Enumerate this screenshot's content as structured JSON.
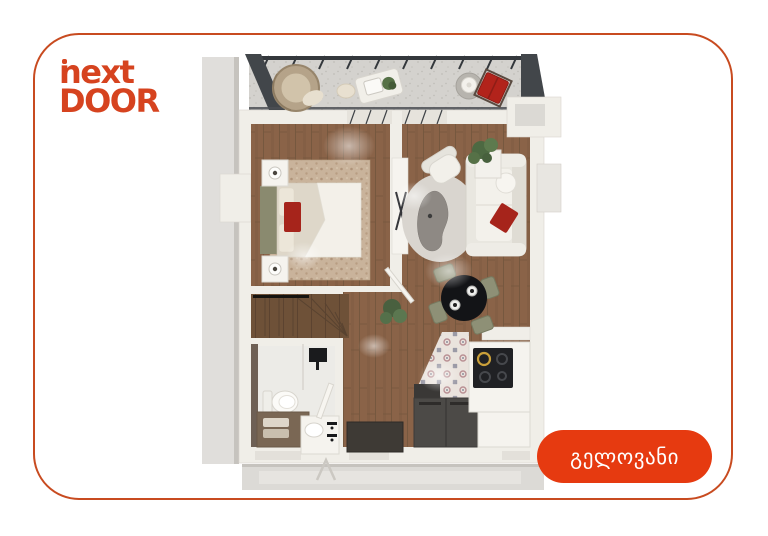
{
  "logo": {
    "line1": "next",
    "line2": "DOOR"
  },
  "badge": {
    "label": "გელოვანი"
  },
  "colors": {
    "background": "#ffffff",
    "card_border": "#c84b20",
    "accent": "#d6431f",
    "badge_bg": "#e63a10",
    "badge_text": "#ffffff",
    "wood_floor": "#8a6348",
    "stairs_wood": "#6e5138",
    "wall": "#f0eee8",
    "slab_gray": "#dcdad6",
    "balcony_floor": "#d4d2ce",
    "railing_dark": "#34383c",
    "olive_furniture": "#8e9076",
    "red_accent": "#a6241b"
  },
  "floor_plan": {
    "elements": [
      "balcony",
      "hanging-chair-icon",
      "balcony-table-icon",
      "red-chair-icon",
      "bedroom",
      "double-bed-icon",
      "nightstand-icon",
      "area-rug-icon",
      "tv-console-icon",
      "living-room",
      "sofa-icon",
      "armchair-icon",
      "coffee-table-icon",
      "plant-icon",
      "dining-table-icon",
      "dining-chair-icon",
      "stairs",
      "bathroom",
      "toilet-icon",
      "vanity-icon",
      "sink-icon",
      "shower-icon",
      "kitchen",
      "cooktop-icon",
      "kitchen-counter-icon",
      "appliance-icon",
      "doormat-icon",
      "entrance-door-icon"
    ]
  }
}
